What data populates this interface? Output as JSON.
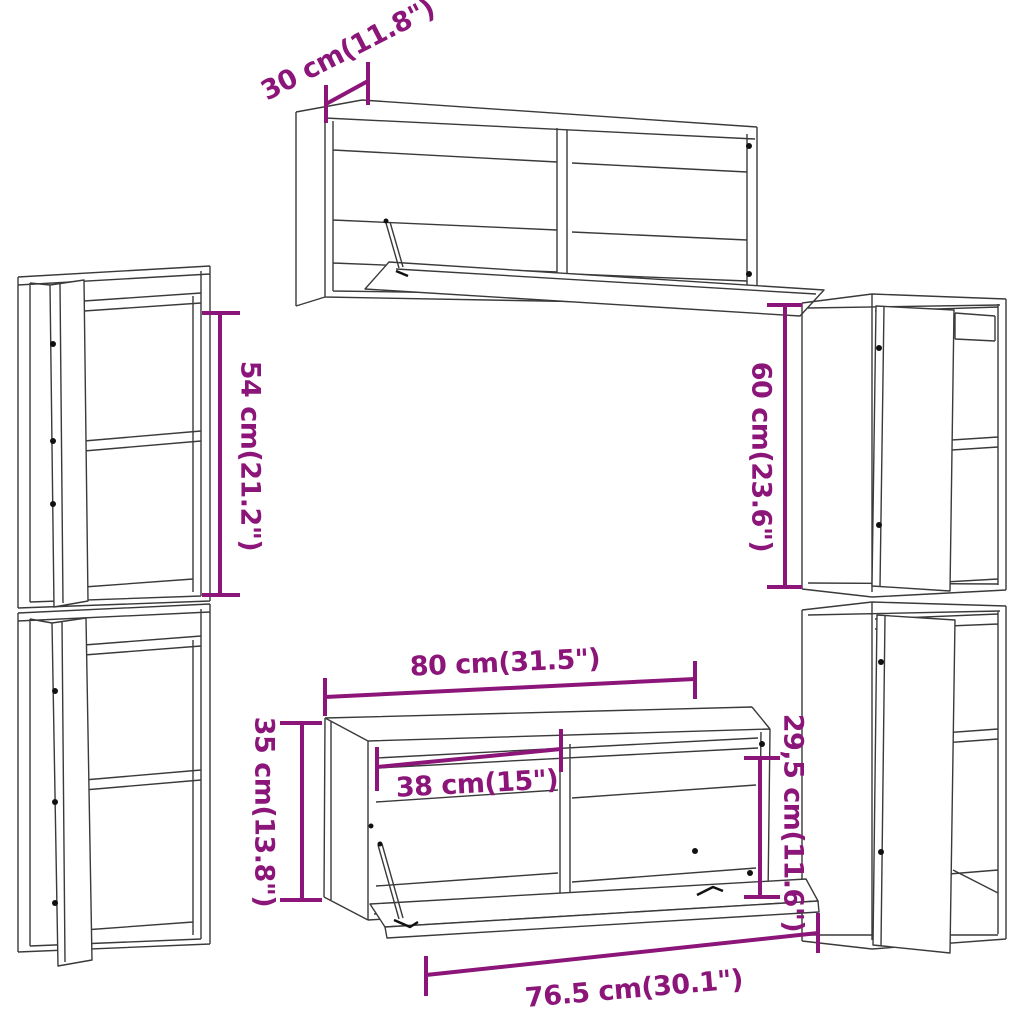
{
  "image": {
    "background": "#ffffff",
    "type": "furniture-dimension-diagram"
  },
  "style": {
    "dimension_color": "#8B1578",
    "line_art_color": "#3a3a3a",
    "hardware_color": "#111111"
  },
  "dimensions": {
    "wall_cabinet_depth": {
      "label": "30 cm(11.8\")"
    },
    "left_cabinet_height": {
      "label": "54 cm(21.2\")"
    },
    "right_cabinet_height": {
      "label": "60 cm(23.6\")"
    },
    "bench_width": {
      "label": "80 cm(31.5\")"
    },
    "bench_inner_width": {
      "label": "38 cm(15\")"
    },
    "bench_height": {
      "label": "35 cm(13.8\")"
    },
    "bench_flap_height": {
      "label": "29,5 cm(11.6\")"
    },
    "bench_flap_width": {
      "label": "76.5 cm(30.1\")"
    }
  }
}
